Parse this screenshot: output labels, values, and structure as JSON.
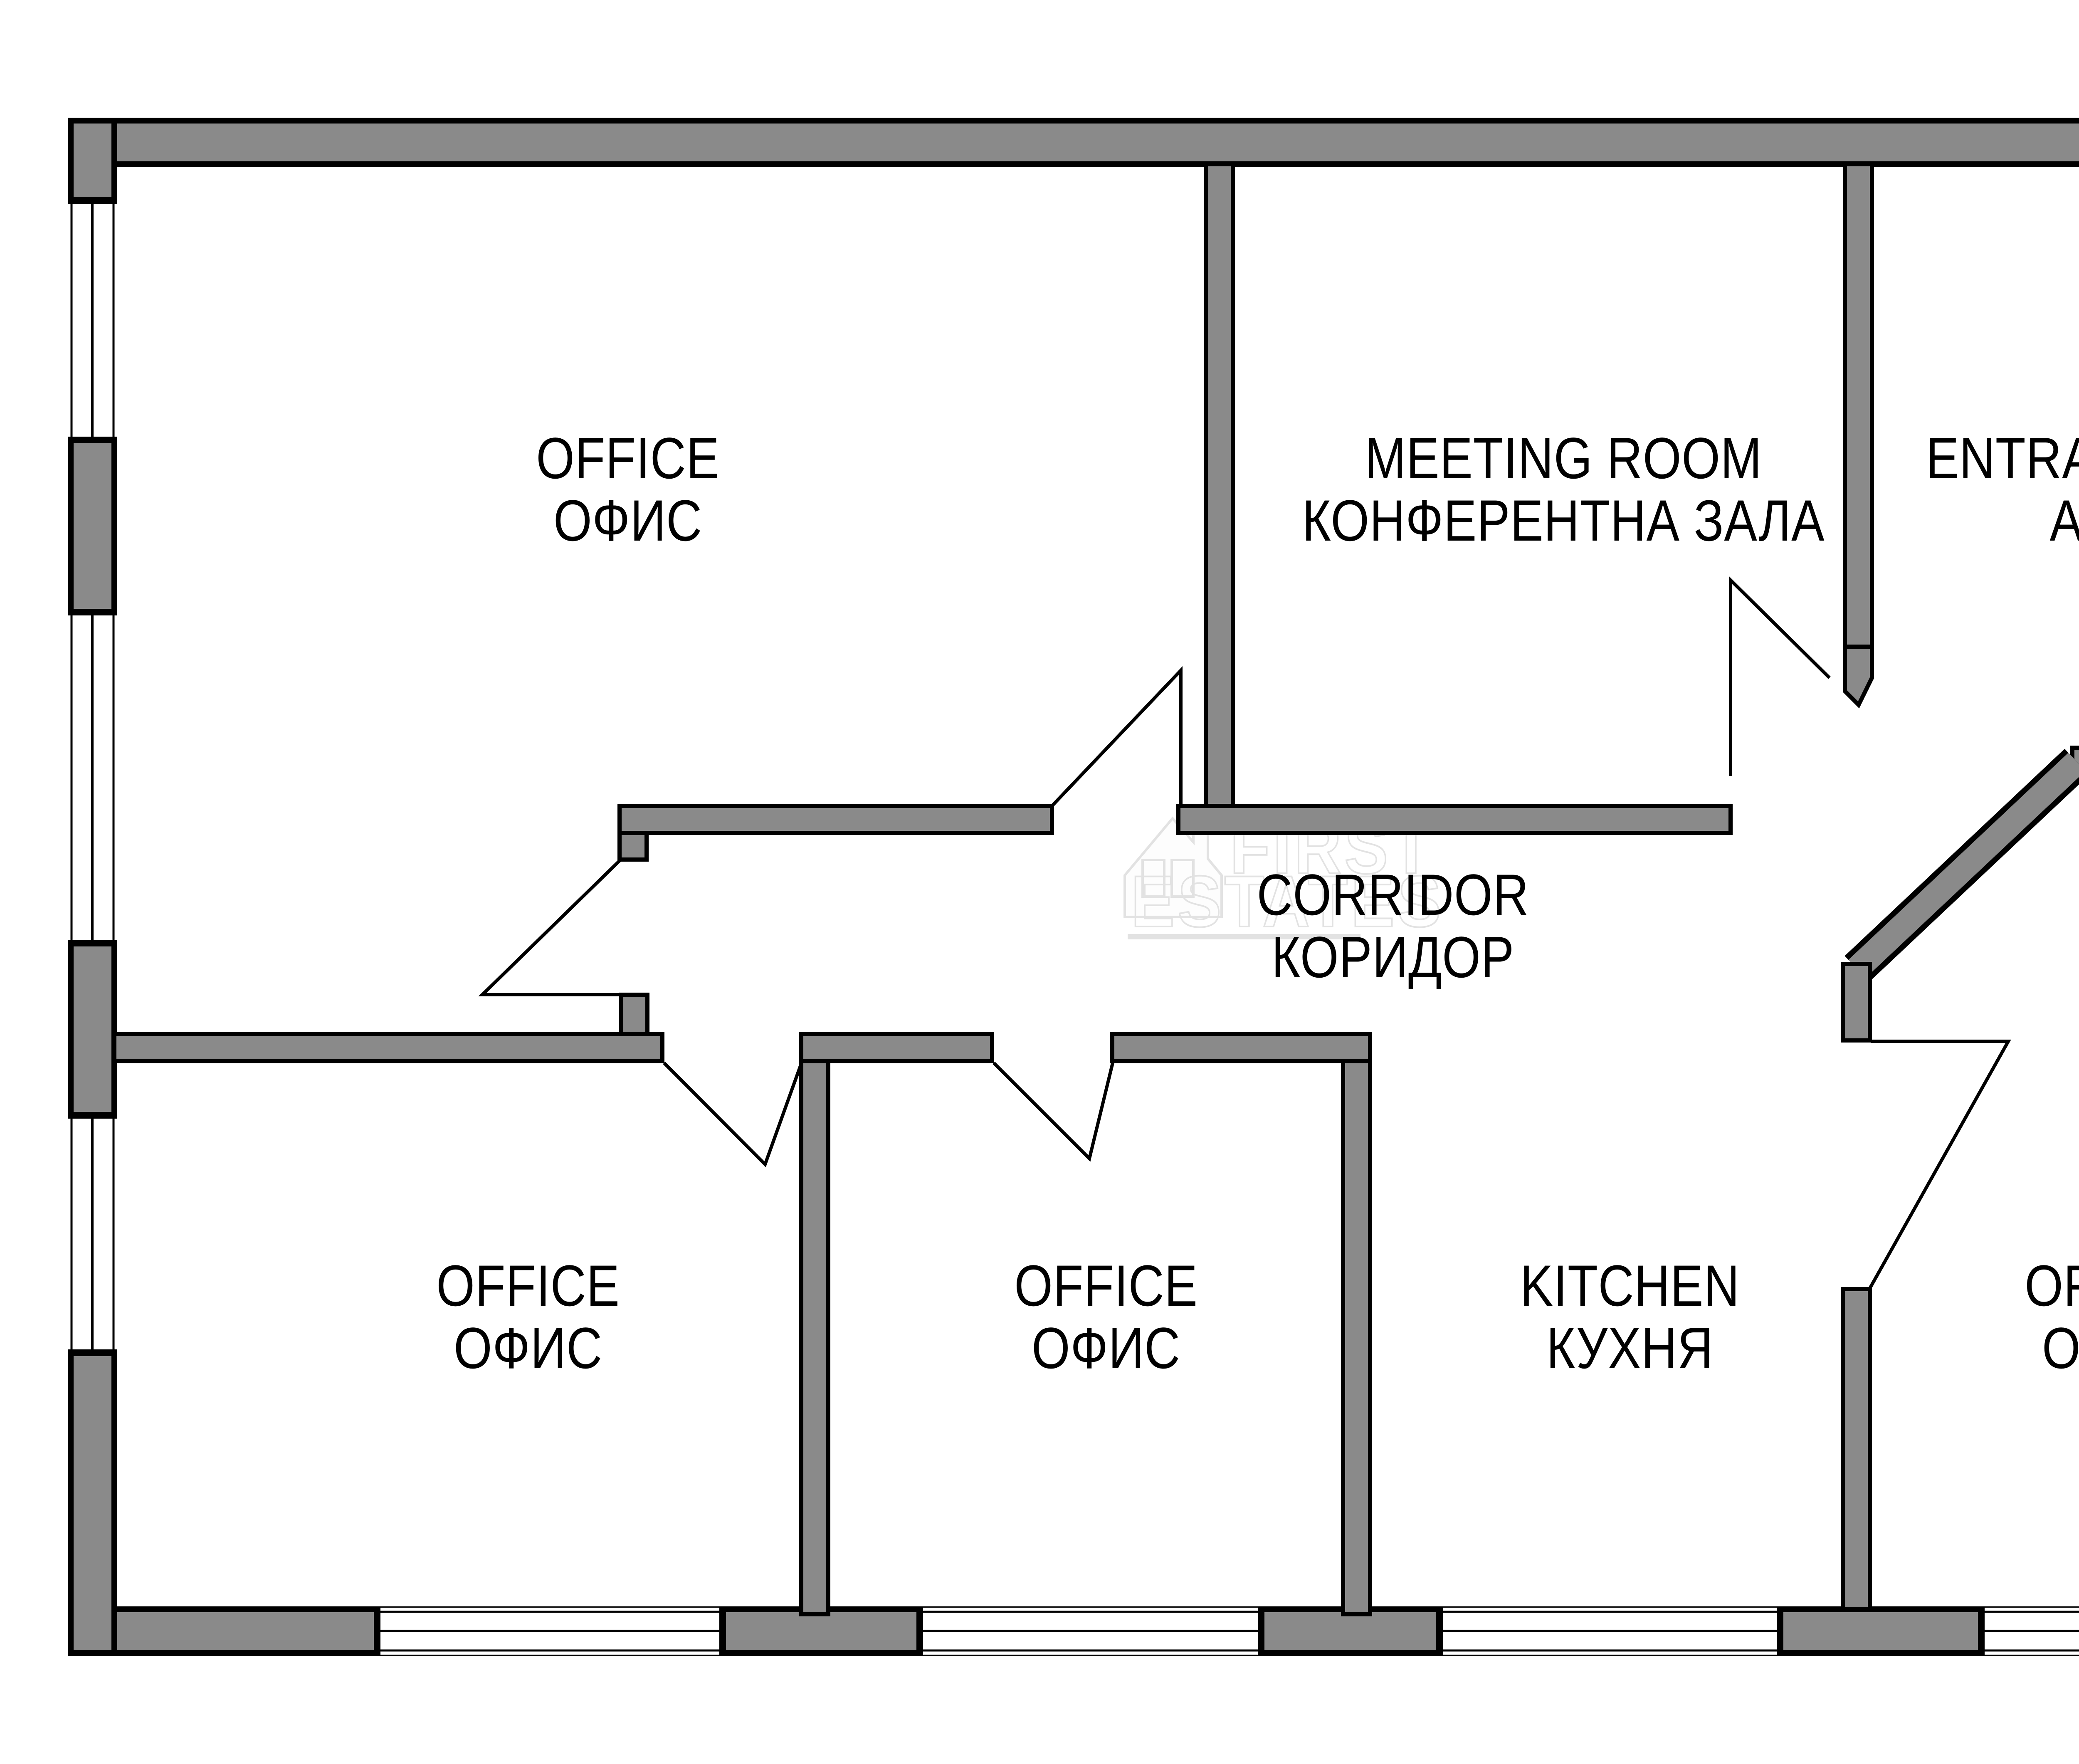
{
  "title": "Office floor plan",
  "colors": {
    "wall_fill": "#8a8a8a",
    "outline": "#000000",
    "background": "#ffffff",
    "watermark": "#e2e2e2"
  },
  "rooms": [
    {
      "id": "office-top-left",
      "name_en": "OFFICE",
      "name_bg": "ОФИС"
    },
    {
      "id": "meeting-room",
      "name_en": "MEETING ROOM",
      "name_bg": "КОНФЕРЕНТНА ЗАЛА"
    },
    {
      "id": "entrance-hall",
      "name_en": "ENTRANCE HALL",
      "name_bg": "АНТРЕ"
    },
    {
      "id": "corridor",
      "name_en": "CORRIDOR",
      "name_bg": "КОРИДОР"
    },
    {
      "id": "office-bottom-left",
      "name_en": "OFFICE",
      "name_bg": "ОФИС"
    },
    {
      "id": "office-bottom-mid",
      "name_en": "OFFICE",
      "name_bg": "ОФИС"
    },
    {
      "id": "kitchen",
      "name_en": "KITCHEN",
      "name_bg": "КУХНЯ"
    },
    {
      "id": "office-bottom-right",
      "name_en": "OFFICE",
      "name_bg": "ОФИС"
    }
  ],
  "watermark": {
    "line1": "FIRST",
    "line2": "ESTATES"
  }
}
